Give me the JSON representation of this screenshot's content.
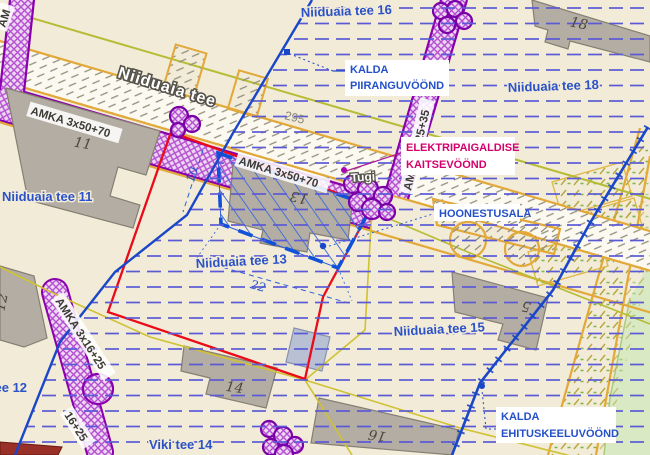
{
  "labels": {
    "streets": {
      "t16": "Niiduaia tee 16",
      "t18": "Niiduaia tee 18",
      "t11": "Niiduaia tee 11",
      "t13": "Niiduaia tee 13",
      "t15": "Niiduaia tee 15",
      "t12": "Niiduaia tee 12",
      "viki": "Viki tee 14",
      "road": "Niiduaia tee"
    },
    "plots": {
      "p11": "11",
      "p13": "13",
      "p18": "18",
      "p14": "14",
      "p16": "16",
      "p5": "5",
      "p12": "12"
    },
    "cables": {
      "main1": "AMKA 3x50+70",
      "main2": "AMKA 3x50+70",
      "branch_top": "AMKA 3x25+35",
      "branch_sw": "AMKA 3x16+25",
      "branch_sw_partial": "16+25",
      "corner_partial": "AM"
    },
    "zones": {
      "piirang1": "KALDA",
      "piirang2": "PIIRANGUVÖÖND",
      "elektri1": "ELEKTRIPAIGALDISE",
      "elektri2": "KAITSEVÖÖND",
      "hoonestus": "HOONESTUSALA",
      "keelu1": "KALDA",
      "keelu2": "EHITUSKEELUVÖÖND"
    },
    "dims": {
      "d10": "10",
      "d22": "22"
    },
    "misc": {
      "tugi": "Tugi",
      "n295": "295"
    }
  },
  "colors": {
    "plan_boundary_red": "#ea0a18",
    "zone_line_blue": "#1a46c8",
    "cable_corridor_purple": "#8800ad",
    "street_label_blue": "#2b52c8",
    "elektri_label_magenta": "#d4006c",
    "cadastral_yellow": "#cfc233",
    "background_cream": "#f2ebd7",
    "building_gray": "#b4ada3",
    "greenery": "#d8e9c4"
  }
}
